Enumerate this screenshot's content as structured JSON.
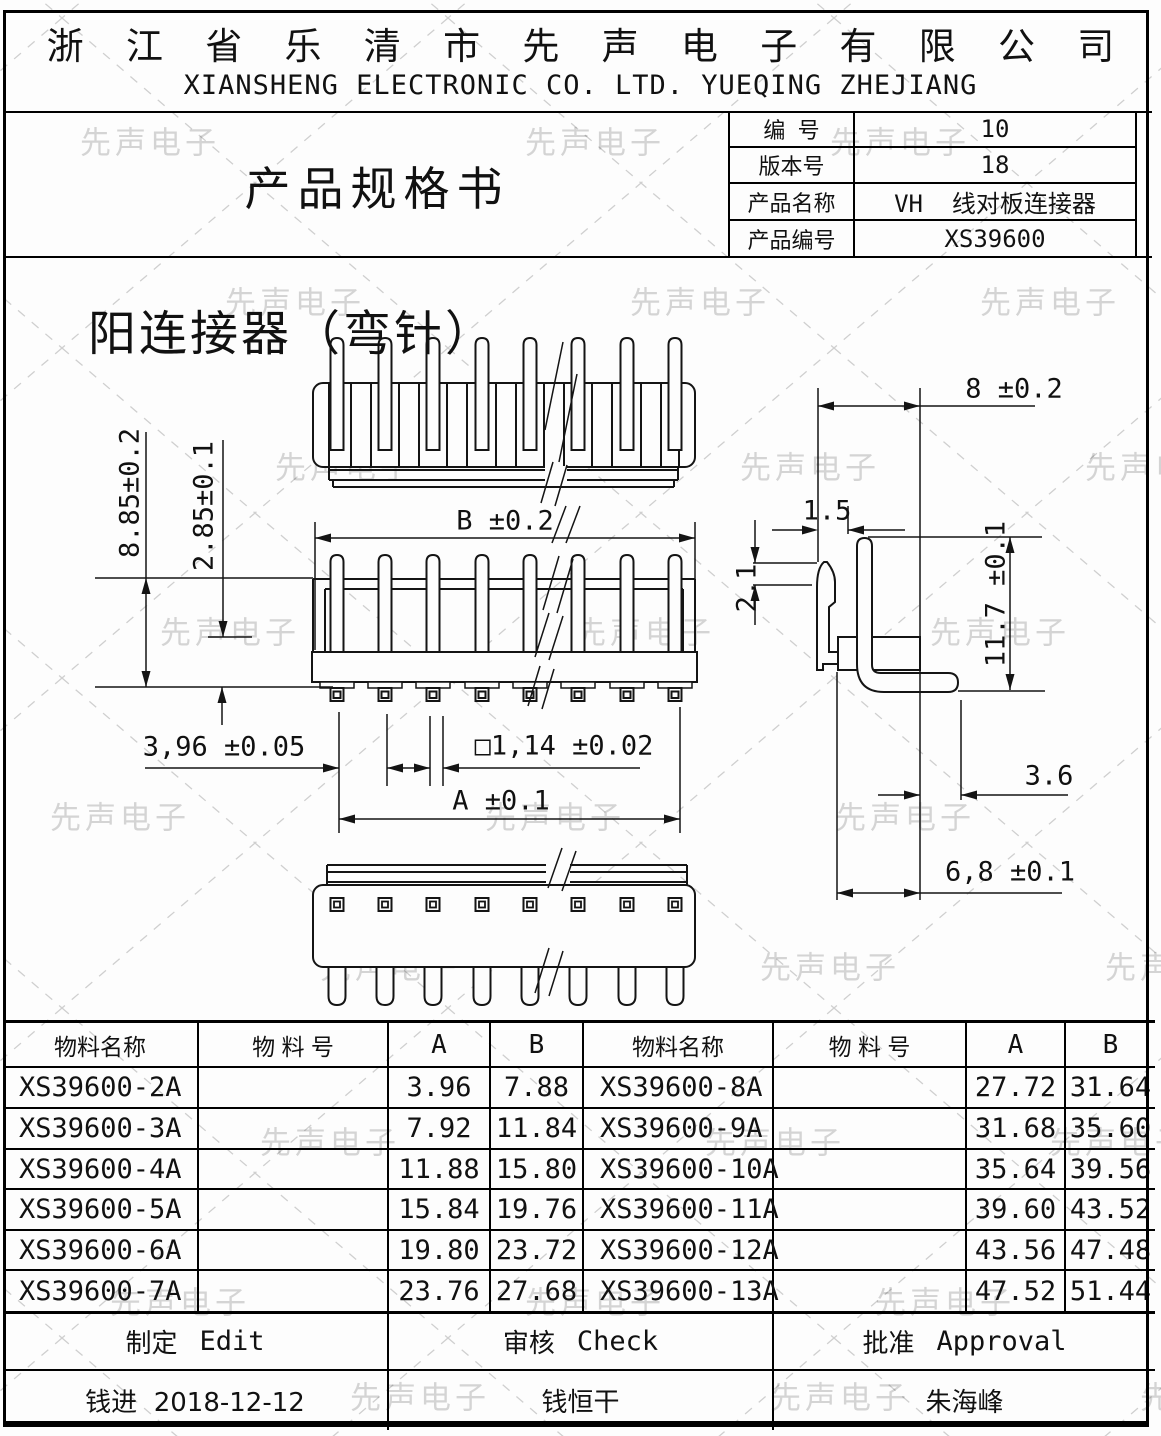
{
  "header": {
    "company_cn": "浙 江 省 乐 清 市 先 声 电 子 有 限 公 司",
    "company_en": "XIANSHENG ELECTRONIC CO. LTD. YUEQING ZHEJIANG"
  },
  "title_block": {
    "doc_title": "产品规格书",
    "fields": [
      {
        "label": "编  号",
        "value": "10"
      },
      {
        "label": "版本号",
        "value": "18"
      },
      {
        "label": "产品名称",
        "value": "VH  线对板连接器"
      },
      {
        "label": "产品编号",
        "value": "XS39600"
      }
    ]
  },
  "drawing": {
    "title": "阳连接器（弯针）",
    "dims": {
      "body_width_b": "B ±0.2",
      "span_a": "A ±0.1",
      "pitch": "3,96 ±0.05",
      "pin_square": "□1,14 ±0.02",
      "height_total": "8.85±0.2",
      "height_upper": "2.85±0.1",
      "depth": "8 ±0.2",
      "latch_width": "1.5",
      "latch_offset": "2.1",
      "height_side": "11.7 ±0.1",
      "tail_len": "3.6",
      "tail_offset": "6,8 ±0.1"
    }
  },
  "parts_table": {
    "headers": [
      "物料名称",
      "物 料 号",
      "A",
      "B",
      "物料名称",
      "物 料 号",
      "A",
      "B"
    ],
    "rows": [
      [
        "XS39600-2A",
        "",
        "3.96",
        "7.88",
        "XS39600-8A",
        "",
        "27.72",
        "31.64"
      ],
      [
        "XS39600-3A",
        "",
        "7.92",
        "11.84",
        "XS39600-9A",
        "",
        "31.68",
        "35.60"
      ],
      [
        "XS39600-4A",
        "",
        "11.88",
        "15.80",
        "XS39600-10A",
        "",
        "35.64",
        "39.56"
      ],
      [
        "XS39600-5A",
        "",
        "15.84",
        "19.76",
        "XS39600-11A",
        "",
        "39.60",
        "43.52"
      ],
      [
        "XS39600-6A",
        "",
        "19.80",
        "23.72",
        "XS39600-12A",
        "",
        "43.56",
        "47.48"
      ],
      [
        "XS39600-7A",
        "",
        "23.76",
        "27.68",
        "XS39600-13A",
        "",
        "47.52",
        "51.44"
      ]
    ]
  },
  "signoff": {
    "roles": [
      {
        "cn": "制定",
        "en": "Edit"
      },
      {
        "cn": "审核",
        "en": "Check"
      },
      {
        "cn": "批准",
        "en": "Approval"
      }
    ],
    "names": [
      "钱进  2018-12-12",
      "钱恒干",
      "朱海峰"
    ]
  },
  "watermark": {
    "text": "先声电子"
  }
}
